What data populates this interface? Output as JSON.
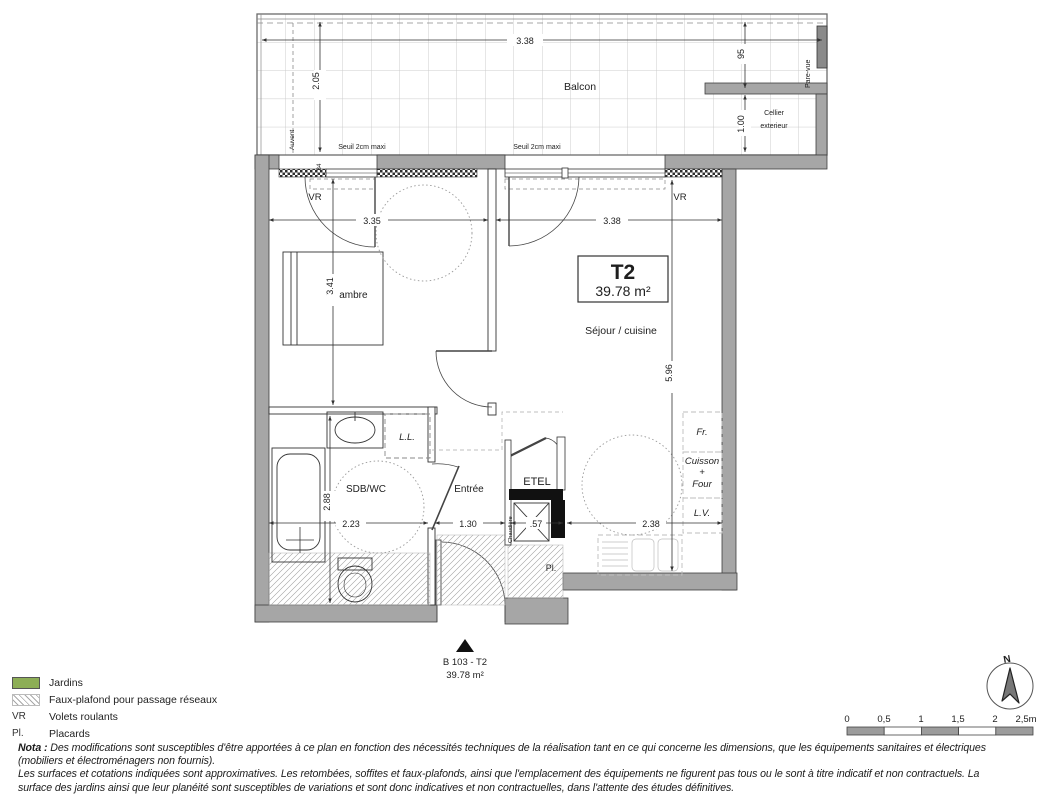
{
  "plan": {
    "balcon_label": "Balcon",
    "title": {
      "type": "T2",
      "area": "39.78 m²"
    },
    "unit": {
      "ref": "B 103 - T2",
      "area": "39.78 m²"
    },
    "labels": {
      "auvent": "Auvent",
      "pare_vue": "Pare-vue",
      "seuil": "Seuil 2cm maxi",
      "cellier_line1": "Cellier",
      "cellier_line2": "exterieur",
      "vr": "VR",
      "chambre": "Chambre",
      "sejour": "Séjour / cuisine",
      "sdb": "SDB/WC",
      "entree": "Entrée",
      "etel": "ETEL",
      "ll": "L.L.",
      "pl": "Pl.",
      "chaudiere": "Chaudière",
      "fr": "Fr.",
      "cuisson": "Cuisson",
      "plus": "+",
      "four": "Four",
      "lv": "L.V."
    },
    "dims": {
      "balcony_w": "3.38",
      "balcony_d": "2.05",
      "d95": "95",
      "d100": "1.00",
      "d34": ".34",
      "chambre_w": "3.35",
      "sejour_w": "3.38",
      "chambre_h": "3.41",
      "sejour_h": "5.96",
      "sdb_h": "2.88",
      "sdb_w": "2.23",
      "entree_w": "1.30",
      "etel_w": ".57",
      "cuisine_w": "2.38"
    }
  },
  "legend": {
    "items": [
      {
        "key": "",
        "label": "Jardins"
      },
      {
        "key": "",
        "label": "Faux-plafond pour passage réseaux"
      },
      {
        "key": "VR",
        "label": "Volets roulants"
      },
      {
        "key": "Pl.",
        "label": "Placards"
      }
    ]
  },
  "nota": {
    "prefix": "Nota :",
    "line1": "Des modifications sont susceptibles d'être apportées à ce plan en fonction des nécessités techniques de la réalisation tant en ce qui concerne les dimensions, que les équipements sanitaires et électriques",
    "line2": "(mobiliers et électroménagers non fournis).",
    "line3": "Les surfaces et cotations indiquées sont approximatives. Les retombées, soffites et faux-plafonds, ainsi que l'emplacement des équipements ne figurent pas tous ou le sont à titre indicatif et non contractuels. La",
    "line4": "surface des jardins ainsi que leur planéité sont susceptibles de variations et sont donc indicatives et non contractuelles, dans l'attente des études définitives."
  },
  "scalebar": {
    "ticks": [
      "0",
      "0,5",
      "1",
      "1,5",
      "2",
      "2,5m"
    ]
  },
  "north": {
    "label": "N"
  },
  "colors": {
    "wall": "#a6a6a6",
    "green": "#8dae56",
    "black": "#111111",
    "gray_text": "#b8b8b8"
  }
}
